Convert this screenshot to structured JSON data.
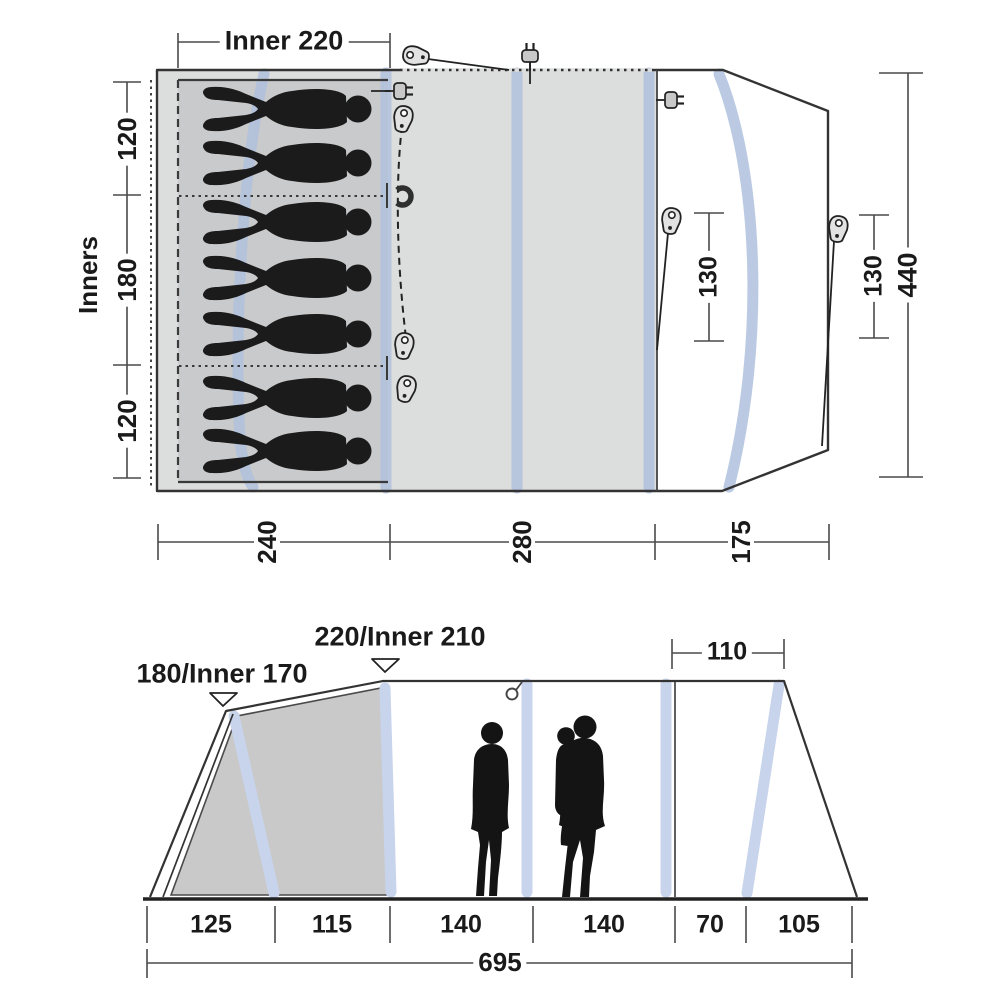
{
  "title": "Tent dimension diagram",
  "plan": {
    "top_inner_dim": "Inner 220",
    "side_label": "Inners",
    "left_dims": [
      "120",
      "180",
      "120"
    ],
    "bottom_dims": [
      "240",
      "280",
      "175"
    ],
    "guy_dim_1": "130",
    "guy_dim_2": "130",
    "total_width_dim": "440",
    "sleeper_count": 7,
    "sections": [
      {
        "name": "sleeping-cabin",
        "width": "240"
      },
      {
        "name": "living-area",
        "width": "280"
      },
      {
        "name": "front-porch",
        "width": "175"
      }
    ]
  },
  "elevation": {
    "peak_left_dim": "180/Inner 170",
    "peak_main_dim": "220/Inner 210",
    "front_top_dim": "110",
    "bottom_dims": [
      "125",
      "115",
      "140",
      "140",
      "70",
      "105"
    ],
    "total_length_dim": "695"
  },
  "icons": {
    "plug": "power-plug-icon",
    "toggle": "zipper-pull-icon",
    "magnet": "magnet-icon",
    "hook": "lantern-hook-icon"
  },
  "colors": {
    "tent_fill": "#dcdddd",
    "inner_fill": "#c9cacb",
    "cabin_fill": "#c9c9c9",
    "air_beam_plan": "#b0c1dd",
    "air_beam_elevation": "#c8d4ec",
    "outline": "#333333",
    "silhouette": "#1b1b1b"
  }
}
